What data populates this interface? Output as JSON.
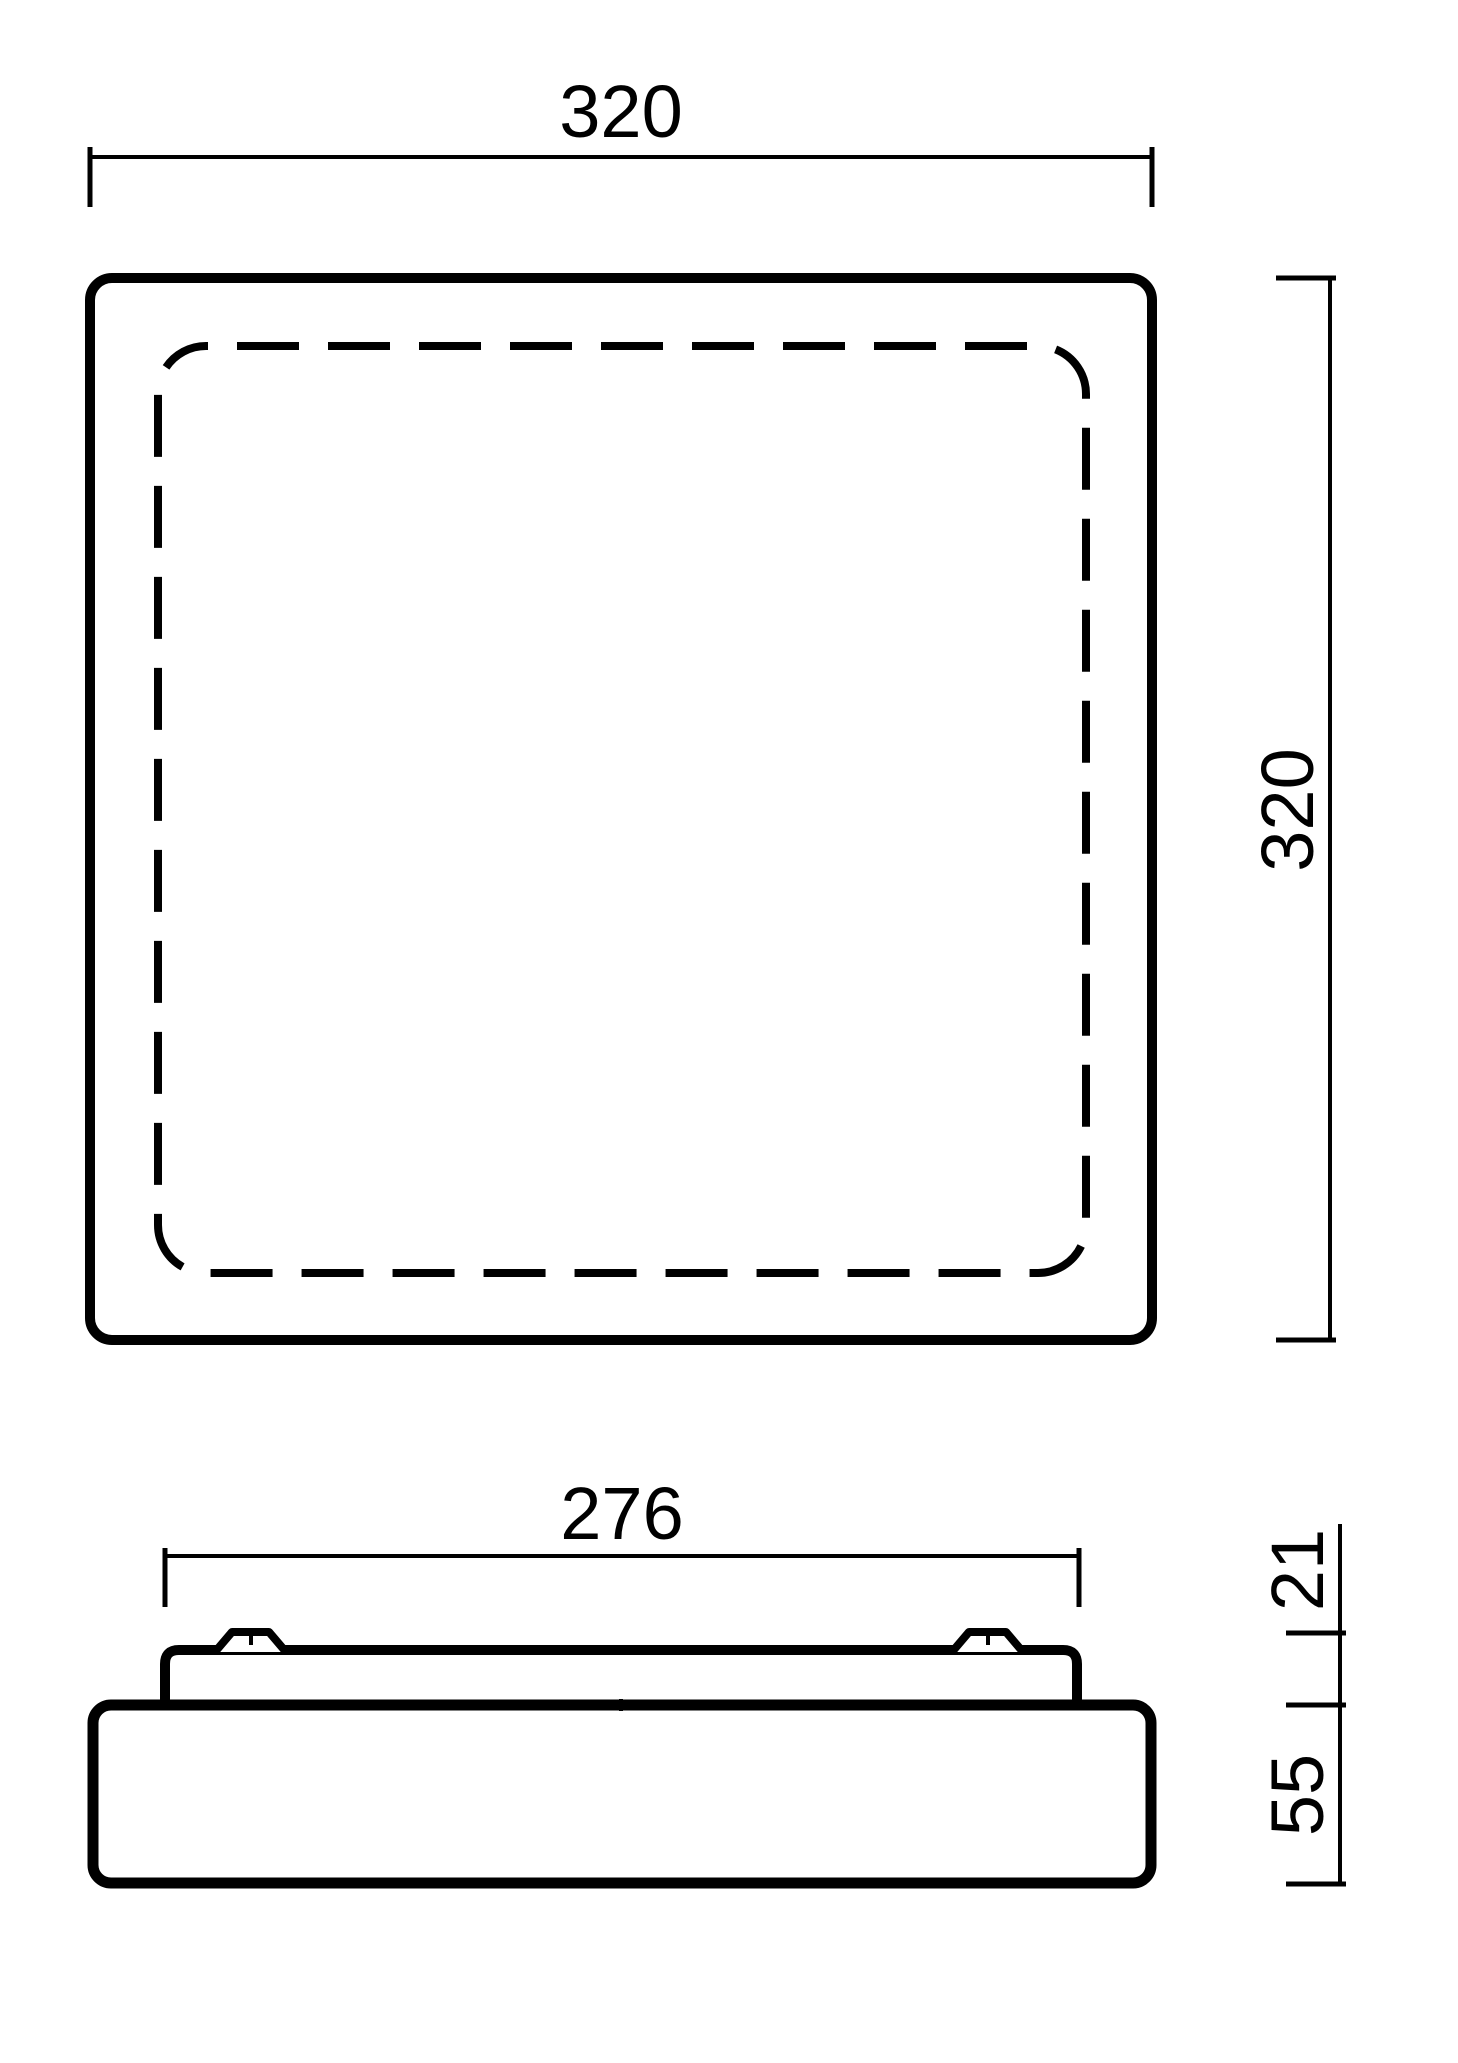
{
  "colors": {
    "line": "#000000",
    "background": "#ffffff"
  },
  "top_view": {
    "width_label": "320",
    "height_label": "320"
  },
  "side_view": {
    "width_label": "276",
    "top_section_label": "21",
    "body_height_label": "55"
  }
}
